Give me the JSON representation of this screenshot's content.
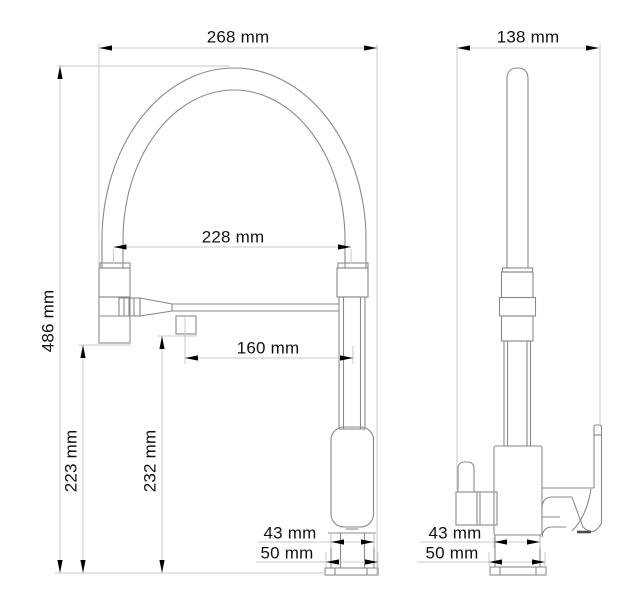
{
  "drawing": {
    "type": "technical-dimension-drawing",
    "subject": "kitchen-faucet-two-views",
    "colors": {
      "background": "#ffffff",
      "outline": "#8a8a8a",
      "dimension_line": "#c9c9c9",
      "arrow": "#000000",
      "text": "#111111"
    },
    "dimensions": {
      "overall_width_front": {
        "label": "268 mm"
      },
      "hose_span": {
        "label": "228 mm"
      },
      "overall_height": {
        "label": "486 mm"
      },
      "spray_head_height": {
        "label": "223 mm"
      },
      "outlet_height": {
        "label": "232 mm"
      },
      "spout_reach": {
        "label": "160 mm"
      },
      "body_width_front": {
        "label": "43 mm"
      },
      "base_width_front": {
        "label": "50 mm"
      },
      "overall_depth_side": {
        "label": "138 mm"
      },
      "body_width_side": {
        "label": "43 mm"
      },
      "base_width_side": {
        "label": "50 mm"
      }
    }
  }
}
